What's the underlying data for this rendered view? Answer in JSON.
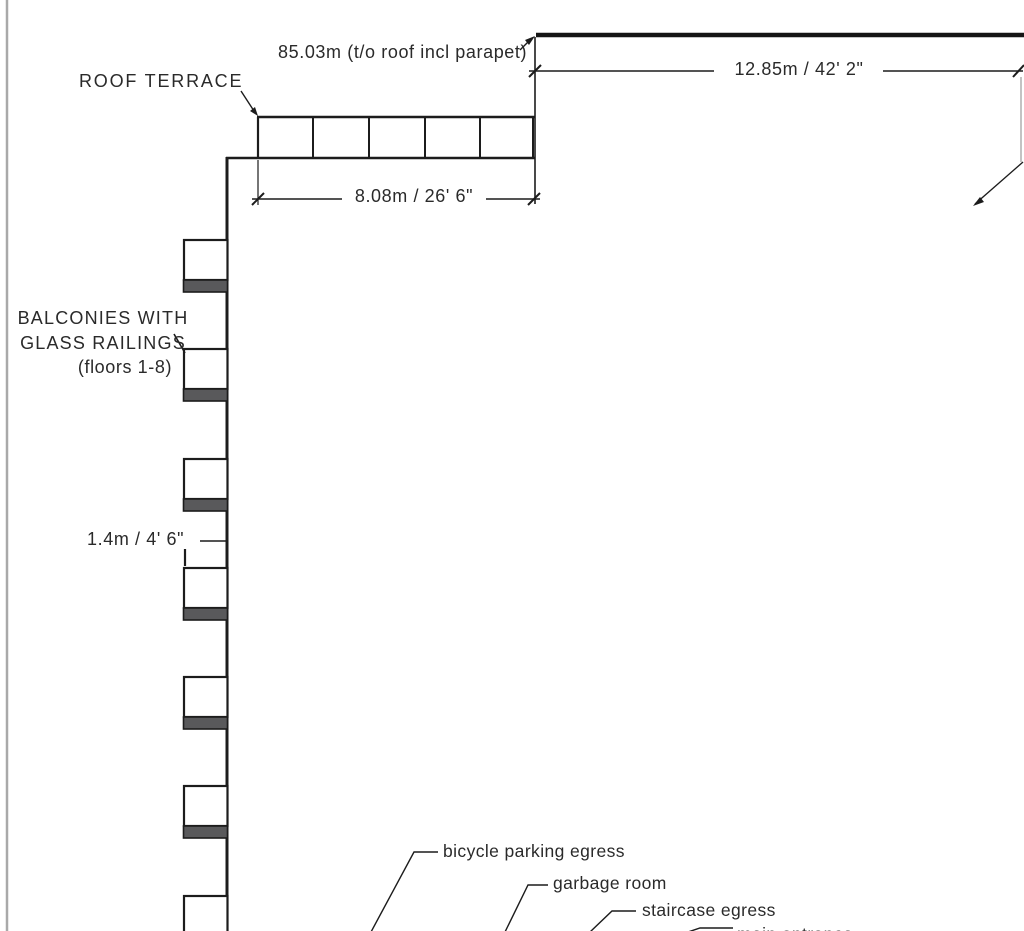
{
  "drawing": {
    "labels": {
      "roof_terrace": "ROOF TERRACE",
      "balconies_line1": "BALCONIES WITH",
      "balconies_line2": "GLASS RAILINGS",
      "balconies_line3": "(floors 1-8)",
      "bicycle_egress": "bicycle parking egress",
      "garbage_room": "garbage room",
      "staircase_egress": "staircase egress",
      "bottom_partial": "main entrance"
    },
    "dimensions": {
      "roof_elevation": "85.03m (t/o roof incl parapet)",
      "upper_roof_width": "12.85m / 42' 2\"",
      "terrace_width": "8.08m / 26' 6\"",
      "balcony_railing_height": "1.4m / 4' 6\""
    },
    "structure": {
      "visible_balconies": 7,
      "terrace_railing_bays": 5
    },
    "colors": {
      "background": "#ffffff",
      "line": "#1c1c1c",
      "slab_fill": "#59595b",
      "sheet_edge": "#a9a9a9",
      "text": "#262626"
    }
  }
}
